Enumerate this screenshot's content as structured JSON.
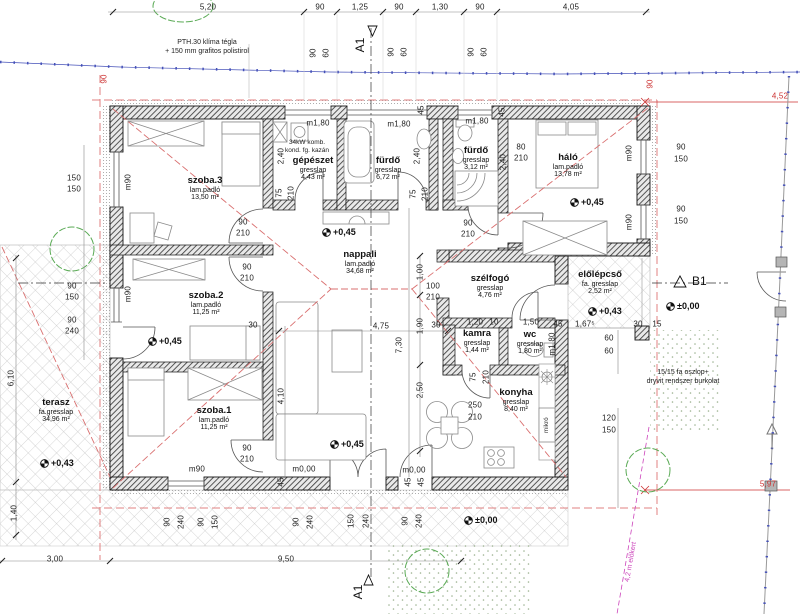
{
  "colors": {
    "red": "#cc3333",
    "blue": "#4450b8",
    "magenta": "#cc44bb",
    "green": "#5aaa55",
    "ink": "#1a1a1a"
  },
  "markers": {
    "a1_top": "A1",
    "a1_bottom": "A1",
    "b1": "B1"
  },
  "rooms": [
    {
      "name": "szoba.3",
      "material": "lam.padló",
      "area": "13,50 m²",
      "x": 205,
      "y": 176
    },
    {
      "name": "gépészet",
      "material": "gresslap",
      "area": "4,43 m²",
      "x": 313,
      "y": 156
    },
    {
      "name": "fürdő",
      "material": "gresslap",
      "area": "6,72 m²",
      "x": 388,
      "y": 156
    },
    {
      "name": "fürdő",
      "material": "gresslap",
      "area": "3,12 m²",
      "x": 476,
      "y": 146
    },
    {
      "name": "háló",
      "material": "lam.padló",
      "area": "13,78 m²",
      "x": 568,
      "y": 153
    },
    {
      "name": "szoba.2",
      "material": "lam.padló",
      "area": "11,25 m²",
      "x": 206,
      "y": 291
    },
    {
      "name": "nappali",
      "material": "lam.padló",
      "area": "34,68 m²",
      "x": 360,
      "y": 250
    },
    {
      "name": "szélfogó",
      "material": "gresslap",
      "area": "4,76 m²",
      "x": 490,
      "y": 274
    },
    {
      "name": "előlépcső",
      "material": "fa. gresslap",
      "area": "2,52 m²",
      "x": 600,
      "y": 270
    },
    {
      "name": "kamra",
      "material": "gresslap",
      "area": "1,44 m²",
      "x": 477,
      "y": 329
    },
    {
      "name": "wc",
      "material": "gresslap",
      "area": "1,80 m²",
      "x": 530,
      "y": 330
    },
    {
      "name": "konyha",
      "material": "gresslap",
      "area": "8,40 m²",
      "x": 516,
      "y": 388
    },
    {
      "name": "szoba.1",
      "material": "lam.padló",
      "area": "11,25 m²",
      "x": 214,
      "y": 406
    },
    {
      "name": "terasz",
      "material": "fa.gresslap",
      "area": "34,96 m²",
      "x": 56,
      "y": 398
    }
  ],
  "levels": [
    {
      "text": "+0,45",
      "x": 322,
      "y": 232
    },
    {
      "text": "+0,45",
      "x": 148,
      "y": 341
    },
    {
      "text": "+0,45",
      "x": 570,
      "y": 202
    },
    {
      "text": "+0,45",
      "x": 330,
      "y": 444
    },
    {
      "text": "+0,43",
      "x": 40,
      "y": 463
    },
    {
      "text": "+0,43",
      "x": 588,
      "y": 311
    },
    {
      "text": "±0,00",
      "x": 666,
      "y": 306
    },
    {
      "text": "±0,00",
      "x": 464,
      "y": 520
    }
  ],
  "dims": [
    {
      "t": "5,20",
      "x": 208,
      "y": 7
    },
    {
      "t": "90",
      "x": 320,
      "y": 7
    },
    {
      "t": "1,25",
      "x": 360,
      "y": 7
    },
    {
      "t": "90",
      "x": 399,
      "y": 7
    },
    {
      "t": "1,30",
      "x": 440,
      "y": 7
    },
    {
      "t": "90",
      "x": 480,
      "y": 7
    },
    {
      "t": "4,05",
      "x": 571,
      "y": 7
    },
    {
      "t": "90",
      "x": 313,
      "y": 53,
      "r": 1
    },
    {
      "t": "60",
      "x": 326,
      "y": 53,
      "r": 1
    },
    {
      "t": "90",
      "x": 391,
      "y": 52,
      "r": 1
    },
    {
      "t": "60",
      "x": 404,
      "y": 52,
      "r": 1
    },
    {
      "t": "90",
      "x": 471,
      "y": 52,
      "r": 1
    },
    {
      "t": "60",
      "x": 484,
      "y": 52,
      "r": 1
    },
    {
      "t": "90",
      "x": 104,
      "y": 79,
      "r": 1,
      "c": "red"
    },
    {
      "t": "90",
      "x": 650,
      "y": 84,
      "r": 1,
      "c": "red"
    },
    {
      "t": "150",
      "x": 74,
      "y": 178
    },
    {
      "t": "150",
      "x": 74,
      "y": 189
    },
    {
      "t": "90",
      "x": 72,
      "y": 286
    },
    {
      "t": "150",
      "x": 72,
      "y": 297
    },
    {
      "t": "90",
      "x": 72,
      "y": 320
    },
    {
      "t": "240",
      "x": 72,
      "y": 331
    },
    {
      "t": "6,10",
      "x": 11,
      "y": 378,
      "r": 1
    },
    {
      "t": "1,40",
      "x": 14,
      "y": 513,
      "r": 1
    },
    {
      "t": "3,00",
      "x": 55,
      "y": 559
    },
    {
      "t": "9,50",
      "x": 286,
      "y": 559
    },
    {
      "t": "90",
      "x": 167,
      "y": 522,
      "r": 1
    },
    {
      "t": "240",
      "x": 181,
      "y": 522,
      "r": 1
    },
    {
      "t": "90",
      "x": 201,
      "y": 522,
      "r": 1
    },
    {
      "t": "150",
      "x": 215,
      "y": 522,
      "r": 1
    },
    {
      "t": "90",
      "x": 296,
      "y": 522,
      "r": 1
    },
    {
      "t": "240",
      "x": 310,
      "y": 522,
      "r": 1
    },
    {
      "t": "150",
      "x": 351,
      "y": 521,
      "r": 1
    },
    {
      "t": "240",
      "x": 366,
      "y": 521,
      "r": 1
    },
    {
      "t": "90",
      "x": 405,
      "y": 521,
      "r": 1
    },
    {
      "t": "240",
      "x": 419,
      "y": 521,
      "r": 1
    },
    {
      "t": "45",
      "x": 281,
      "y": 482,
      "r": 1
    },
    {
      "t": "45",
      "x": 408,
      "y": 482,
      "r": 1
    },
    {
      "t": "45",
      "x": 421,
      "y": 482,
      "r": 1
    },
    {
      "t": "45",
      "x": 421,
      "y": 110,
      "r": 1
    },
    {
      "t": "45",
      "x": 502,
      "y": 112,
      "r": 1
    },
    {
      "t": "90",
      "x": 681,
      "y": 147
    },
    {
      "t": "150",
      "x": 681,
      "y": 159
    },
    {
      "t": "90",
      "x": 681,
      "y": 209
    },
    {
      "t": "150",
      "x": 681,
      "y": 221
    },
    {
      "t": "30",
      "x": 638,
      "y": 324
    },
    {
      "t": "15",
      "x": 657,
      "y": 324
    },
    {
      "t": "60",
      "x": 609,
      "y": 338
    },
    {
      "t": "60",
      "x": 609,
      "y": 351
    },
    {
      "t": "120",
      "x": 609,
      "y": 418
    },
    {
      "t": "150",
      "x": 609,
      "y": 430
    },
    {
      "t": "1,00",
      "x": 420,
      "y": 272,
      "r": 1
    },
    {
      "t": "100",
      "x": 433,
      "y": 286
    },
    {
      "t": "210",
      "x": 433,
      "y": 297
    },
    {
      "t": "1,90",
      "x": 420,
      "y": 326,
      "r": 1
    },
    {
      "t": "7,30",
      "x": 399,
      "y": 345,
      "r": 1
    },
    {
      "t": "2,50",
      "x": 420,
      "y": 390,
      "r": 1
    },
    {
      "t": "4,75",
      "x": 381,
      "y": 326
    },
    {
      "t": "4,10",
      "x": 281,
      "y": 396,
      "r": 1
    },
    {
      "t": "30",
      "x": 253,
      "y": 325
    },
    {
      "t": "30",
      "x": 436,
      "y": 325
    },
    {
      "t": "1,20",
      "x": 475,
      "y": 322
    },
    {
      "t": "10",
      "x": 494,
      "y": 322
    },
    {
      "t": "1,50",
      "x": 531,
      "y": 322
    },
    {
      "t": "45",
      "x": 558,
      "y": 324
    },
    {
      "t": "1,67⁵",
      "x": 585,
      "y": 324
    },
    {
      "t": "90",
      "x": 243,
      "y": 222
    },
    {
      "t": "210",
      "x": 243,
      "y": 233
    },
    {
      "t": "90",
      "x": 247,
      "y": 267
    },
    {
      "t": "210",
      "x": 247,
      "y": 278
    },
    {
      "t": "90",
      "x": 247,
      "y": 448
    },
    {
      "t": "210",
      "x": 247,
      "y": 459
    },
    {
      "t": "90",
      "x": 468,
      "y": 223
    },
    {
      "t": "210",
      "x": 468,
      "y": 234
    },
    {
      "t": "80",
      "x": 521,
      "y": 147
    },
    {
      "t": "210",
      "x": 521,
      "y": 158
    },
    {
      "t": "250",
      "x": 475,
      "y": 405
    },
    {
      "t": "210",
      "x": 475,
      "y": 417
    },
    {
      "t": "75",
      "x": 279,
      "y": 193,
      "r": 1
    },
    {
      "t": "210",
      "x": 291,
      "y": 193,
      "r": 1
    },
    {
      "t": "75",
      "x": 413,
      "y": 194,
      "r": 1
    },
    {
      "t": "210",
      "x": 425,
      "y": 194,
      "r": 1
    },
    {
      "t": "75",
      "x": 473,
      "y": 377,
      "r": 1
    },
    {
      "t": "210",
      "x": 486,
      "y": 377,
      "r": 1
    },
    {
      "t": "2,40",
      "x": 281,
      "y": 156,
      "r": 1
    },
    {
      "t": "2,40",
      "x": 417,
      "y": 156,
      "r": 1
    },
    {
      "t": "2,40",
      "x": 503,
      "y": 162,
      "r": 1
    },
    {
      "t": "m90",
      "x": 128,
      "y": 182,
      "r": 1
    },
    {
      "t": "m90",
      "x": 128,
      "y": 294,
      "r": 1
    },
    {
      "t": "m90",
      "x": 629,
      "y": 153,
      "r": 1
    },
    {
      "t": "m90",
      "x": 629,
      "y": 222,
      "r": 1
    },
    {
      "t": "m90",
      "x": 197,
      "y": 469
    },
    {
      "t": "m0,00",
      "x": 304,
      "y": 469
    },
    {
      "t": "m0,00",
      "x": 414,
      "y": 470
    },
    {
      "t": "m1,80",
      "x": 318,
      "y": 123
    },
    {
      "t": "m1,80",
      "x": 399,
      "y": 124
    },
    {
      "t": "m1,80",
      "x": 477,
      "y": 121
    },
    {
      "t": "m1,80",
      "x": 552,
      "y": 344,
      "r": 1
    },
    {
      "t": "mikró",
      "x": 547,
      "y": 425,
      "r": 1,
      "s": 6
    },
    {
      "t": "4,52",
      "x": 780,
      "y": 96,
      "c": "red"
    },
    {
      "t": "5,97",
      "x": 768,
      "y": 484,
      "c": "red"
    }
  ],
  "notes": [
    {
      "lines": [
        "PTH.30 klíma tégla",
        "+ 150 mm grafitos polistirol"
      ],
      "x": 207,
      "y": 38
    },
    {
      "lines": [
        "34kW komb.",
        "kond. fg. kazán"
      ],
      "x": 307,
      "y": 139,
      "s": 6.5
    },
    {
      "lines": [
        "15/15 fa oszlop+",
        "dryvit rendszer burkolat"
      ],
      "x": 683,
      "y": 368
    },
    {
      "lines": [
        "4,2 m előkert"
      ],
      "x": 631,
      "y": 562,
      "rot": 1,
      "c": "mag"
    }
  ]
}
